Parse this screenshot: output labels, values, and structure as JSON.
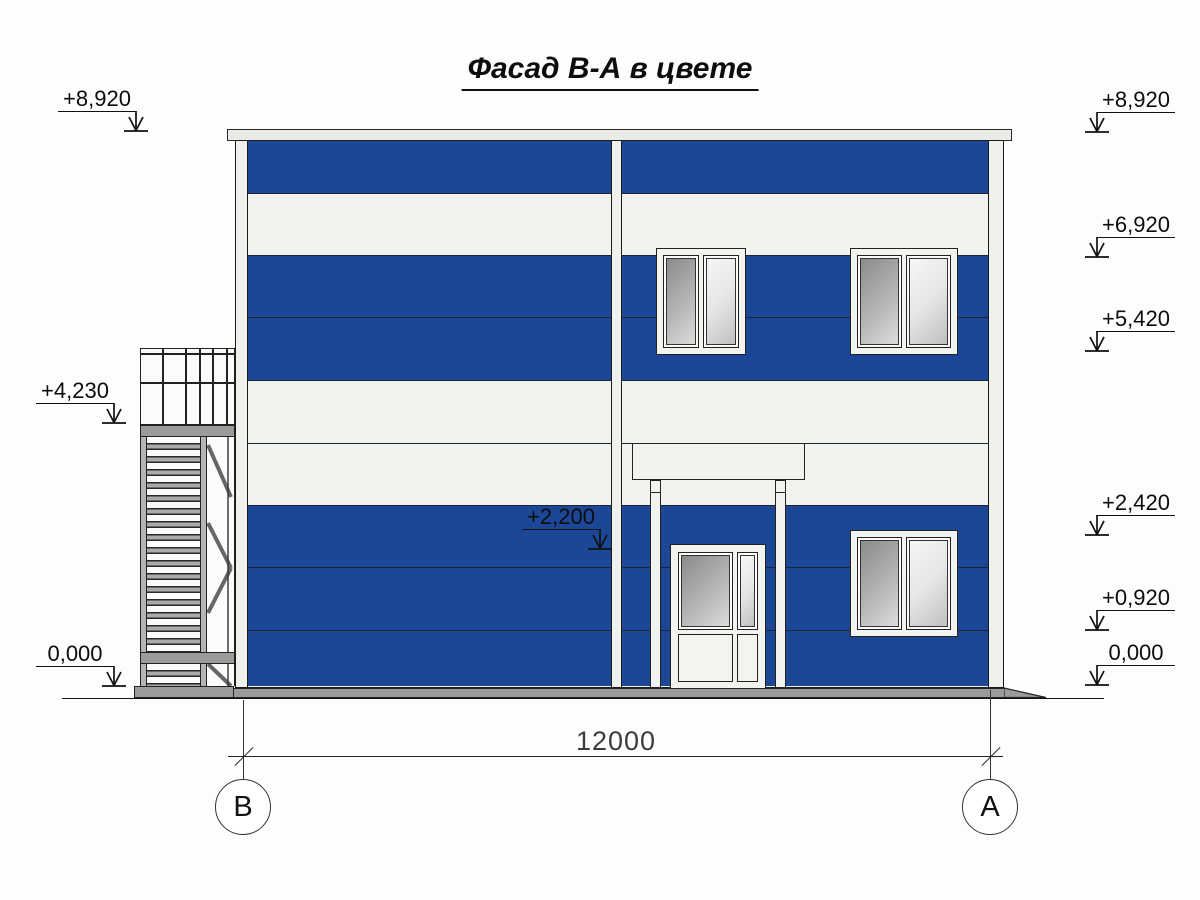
{
  "title": "Фасад В-А в цвете",
  "elevation_markers": {
    "left": [
      {
        "value": "+8,920"
      },
      {
        "value": "+4,230"
      },
      {
        "value": "0,000"
      }
    ],
    "middle": [
      {
        "value": "+2,200"
      }
    ],
    "right": [
      {
        "value": "+8,920"
      },
      {
        "value": "+6,920"
      },
      {
        "value": "+5,420"
      },
      {
        "value": "+2,420"
      },
      {
        "value": "+0,920"
      },
      {
        "value": "0,000"
      }
    ]
  },
  "dimension": {
    "value": "12000"
  },
  "axes": [
    {
      "label": "В"
    },
    {
      "label": "А"
    }
  ],
  "colors": {
    "panel_blue": "#1c4796",
    "panel_white": "#f0f3ee",
    "frame_white": "#f2f4f0",
    "steel_gray": "#9b9b9b",
    "glass_dark": "#8b8b8b",
    "glass_light": "#f6f6f6",
    "line_dark": "#1b1b1b"
  }
}
